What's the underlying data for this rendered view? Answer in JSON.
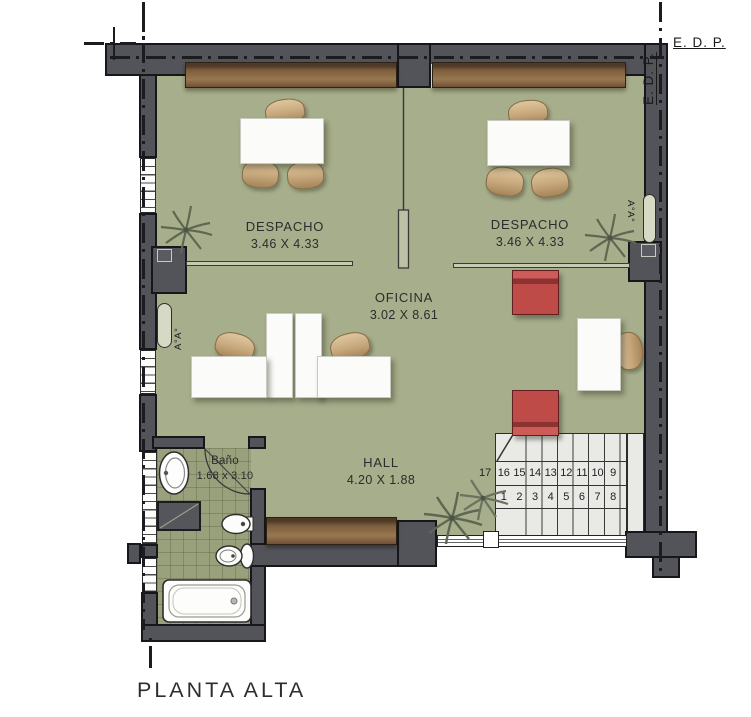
{
  "plan": {
    "title": "PLANTA ALTA",
    "rooms": {
      "despacho_left": {
        "name": "DESPACHO",
        "dims": "3.46 X 4.33"
      },
      "despacho_right": {
        "name": "DESPACHO",
        "dims": "3.46 X 4.33"
      },
      "oficina": {
        "name": "OFICINA",
        "dims": "3.02 X 8.61"
      },
      "hall": {
        "name": "HALL",
        "dims": "4.20 X 1.88"
      },
      "bano": {
        "name": "Baño",
        "dims": "1.68 x 3.10"
      }
    },
    "annotations": {
      "edp_top": "E. D. P.",
      "edp_side": "E. D. P.",
      "vent_left": "A°A°",
      "vent_right": "A°A°"
    },
    "stairs": {
      "upper_run": [
        "17",
        "16",
        "15",
        "14",
        "13",
        "12",
        "11",
        "10",
        "9"
      ],
      "lower_run": [
        "1",
        "2",
        "3",
        "4",
        "5",
        "6",
        "7",
        "8"
      ]
    },
    "colors": {
      "wall": "#53535a",
      "floor": "#a7ae8b",
      "bath_floor": "#99a17c",
      "wood": "#8a6845",
      "stairs": "#e9e9e6",
      "chair_red": "#bf4b48",
      "chair_tan": "#c9ad83"
    }
  }
}
